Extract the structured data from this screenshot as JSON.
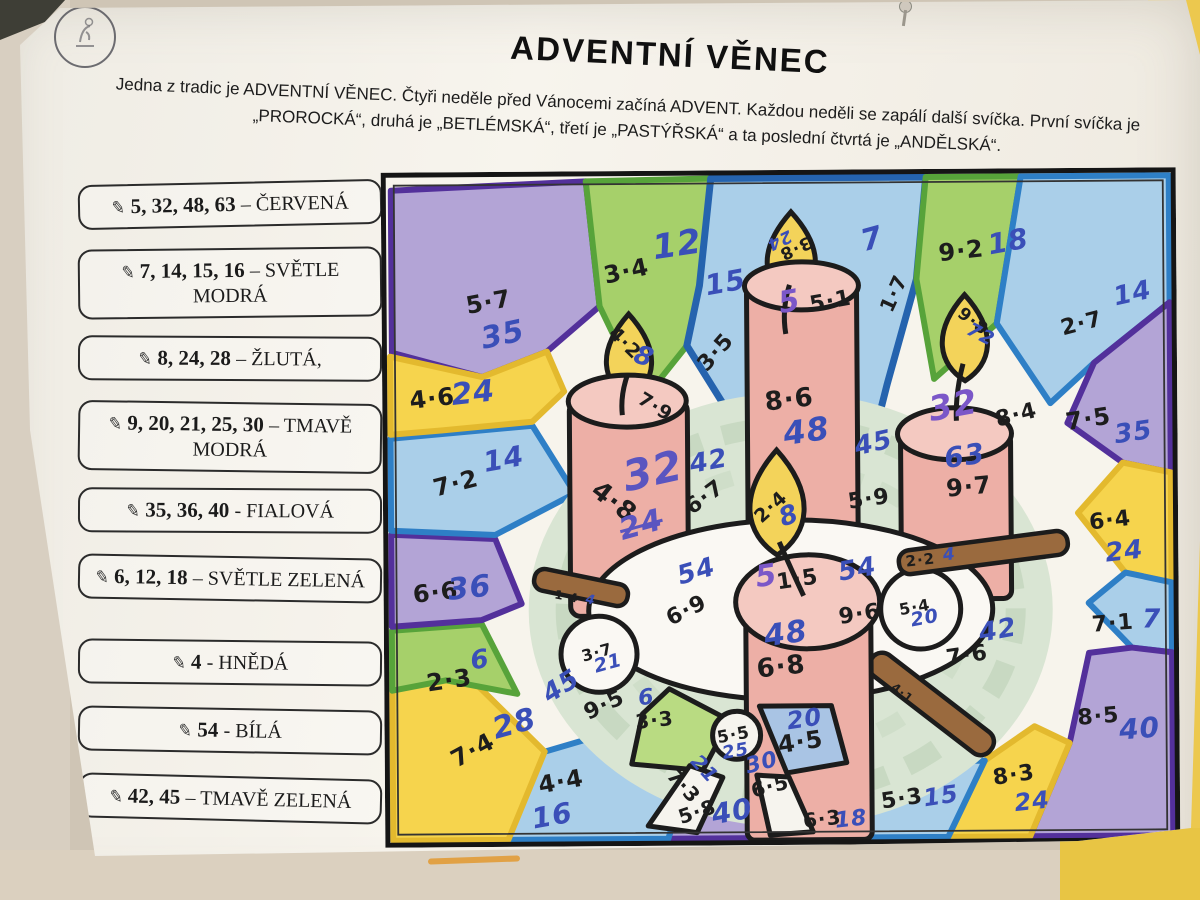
{
  "header": {
    "title": "ADVENTNÍ VĚNEC",
    "intro_line1": "Jedna z tradic je ADVENTNÍ VĚNEC. Čtyři neděle před Vánocemi začíná ADVENT. Každou neděli se zapálí další svíčka. První svíčka je",
    "intro_line2": "„PROROCKÁ“, druhá je „BETLÉMSKÁ“, třetí je „PASTÝŘSKÁ“ a ta poslední čtvrtá je „ANDĚLSKÁ“."
  },
  "decor": {
    "stamp": "school-stamp",
    "pin": "push-pin",
    "pencil_icon": "✎"
  },
  "colors": {
    "pen_blue": "#3a4fb8",
    "pen_purple": "#7b57c8",
    "pen_purple_blue": "#5a55c0",
    "crayon_red": "#edafa6",
    "crayon_yellow": "#f6d44d",
    "crayon_light_blue": "#aacfe9",
    "crayon_dark_blue": "#2e6cb5",
    "crayon_purple": "#b3a4d6",
    "crayon_light_green": "#a6d06a",
    "crayon_dark_green": "#57a33a",
    "crayon_brown": "#9a6a3e"
  },
  "legend": {
    "items": [
      {
        "nums": "5, 32, 48, 63",
        "rest": "– ČERVENÁ"
      },
      {
        "nums": "7, 14, 15, 16",
        "rest": "– SVĚTLE MODRÁ"
      },
      {
        "nums": "8, 24, 28",
        "rest": "– ŽLUTÁ,"
      },
      {
        "nums": "9, 20, 21, 25, 30",
        "rest": "– TMAVĚ MODRÁ"
      },
      {
        "nums": "35, 36, 40",
        "rest": "- FIALOVÁ"
      },
      {
        "nums": "6, 12, 18",
        "rest": "– SVĚTLE ZELENÁ"
      },
      {
        "nums": "4",
        "rest": "- HNĚDÁ"
      },
      {
        "nums": "54",
        "rest": "- BÍLÁ"
      },
      {
        "nums": "42, 45",
        "rest": "– TMAVĚ ZELENÁ"
      }
    ]
  },
  "problems": [
    {
      "p": "5·7",
      "x": 107,
      "y": 130,
      "r": -10,
      "s": 24,
      "a": "35",
      "ac": "blue",
      "ax": 121,
      "ay": 163,
      "ar": -12,
      "as": 30
    },
    {
      "p": "3·4",
      "x": 245,
      "y": 100,
      "r": -12,
      "s": 24,
      "a": "12",
      "ac": "blue",
      "ax": 296,
      "ay": 74,
      "ar": -8,
      "as": 34
    },
    {
      "p": "3·5",
      "x": 334,
      "y": 182,
      "r": -48,
      "s": 22,
      "a": "15",
      "ac": "blue",
      "ax": 344,
      "ay": 112,
      "ar": -10,
      "as": 28
    },
    {
      "p": "1·7",
      "x": 512,
      "y": 124,
      "r": -65,
      "s": 20,
      "a": "7",
      "ac": "blue",
      "ax": 491,
      "ay": 70,
      "ar": -15,
      "as": 30
    },
    {
      "p": "9·2",
      "x": 580,
      "y": 82,
      "r": -6,
      "s": 24,
      "a": "18",
      "ac": "blue",
      "ax": 627,
      "ay": 73,
      "ar": -10,
      "as": 28
    },
    {
      "p": "2·7",
      "x": 700,
      "y": 156,
      "r": -14,
      "s": 22,
      "a": "14",
      "ac": "blue",
      "ax": 751,
      "ay": 126,
      "ar": -12,
      "as": 26
    },
    {
      "p": "7·5",
      "x": 706,
      "y": 251,
      "r": -8,
      "s": 24,
      "a": "35",
      "ac": "blue",
      "ax": 751,
      "ay": 265,
      "ar": -8,
      "as": 26
    },
    {
      "p": "6·4",
      "x": 727,
      "y": 353,
      "r": -6,
      "s": 22,
      "a": "24",
      "ac": "blue",
      "ax": 741,
      "ay": 384,
      "ar": -6,
      "as": 26
    },
    {
      "p": "7·1",
      "x": 729,
      "y": 456,
      "r": -4,
      "s": 22,
      "a": "7",
      "ac": "blue",
      "ax": 768,
      "ay": 452,
      "ar": 0,
      "as": 26
    },
    {
      "p": "8·5",
      "x": 714,
      "y": 549,
      "r": -4,
      "s": 22,
      "a": "40",
      "ac": "blue",
      "ax": 755,
      "ay": 561,
      "ar": -4,
      "as": 28
    },
    {
      "p": "8·3",
      "x": 629,
      "y": 607,
      "r": -8,
      "s": 22,
      "a": "24",
      "ac": "blue",
      "ax": 647,
      "ay": 633,
      "ar": -6,
      "as": 24
    },
    {
      "p": "5·3",
      "x": 517,
      "y": 630,
      "r": -8,
      "s": 22,
      "a": "15",
      "ac": "blue",
      "ax": 556,
      "ay": 627,
      "ar": -8,
      "as": 24
    },
    {
      "p": "6·3",
      "x": 437,
      "y": 649,
      "r": -6,
      "s": 20,
      "a": "18",
      "ac": "blue",
      "ax": 466,
      "ay": 650,
      "ar": -6,
      "as": 22
    },
    {
      "p": "5·8",
      "x": 312,
      "y": 641,
      "r": -18,
      "s": 20,
      "a": "40",
      "ac": "blue",
      "ax": 347,
      "ay": 641,
      "ar": -10,
      "as": 28
    },
    {
      "p": "4·4",
      "x": 176,
      "y": 610,
      "r": -10,
      "s": 24,
      "a": "16",
      "ac": "blue",
      "ax": 167,
      "ay": 644,
      "ar": -10,
      "as": 28
    },
    {
      "p": "7·4",
      "x": 88,
      "y": 578,
      "r": -28,
      "s": 24,
      "a": "28",
      "ac": "blue",
      "ax": 130,
      "ay": 552,
      "ar": -15,
      "as": 30
    },
    {
      "p": "2·3",
      "x": 65,
      "y": 508,
      "r": -8,
      "s": 24,
      "a": "6",
      "ac": "blue",
      "ax": 96,
      "ay": 488,
      "ar": -8,
      "as": 26
    },
    {
      "p": "6·6",
      "x": 52,
      "y": 420,
      "r": -6,
      "s": 24,
      "a": "36",
      "ac": "blue",
      "ax": 86,
      "ay": 416,
      "ar": -6,
      "as": 30
    },
    {
      "p": "7·2",
      "x": 73,
      "y": 311,
      "r": -14,
      "s": 24,
      "a": "14",
      "ac": "blue",
      "ax": 121,
      "ay": 287,
      "ar": -10,
      "as": 28
    },
    {
      "p": "4·6",
      "x": 50,
      "y": 226,
      "r": -6,
      "s": 24,
      "a": "24",
      "ac": "blue",
      "ax": 91,
      "ay": 221,
      "ar": -6,
      "as": 30
    },
    {
      "p": "6·7",
      "x": 322,
      "y": 327,
      "r": -36,
      "s": 22,
      "a": "42",
      "ac": "blue",
      "ax": 326,
      "ay": 291,
      "ar": -10,
      "as": 26
    },
    {
      "p": "5·9",
      "x": 486,
      "y": 330,
      "r": -8,
      "s": 22,
      "a": "45",
      "ac": "blue",
      "ax": 491,
      "ay": 274,
      "ar": -12,
      "as": 26
    },
    {
      "p": "6·9",
      "x": 303,
      "y": 440,
      "r": -26,
      "s": 22,
      "a": "54",
      "ac": "blue",
      "ax": 313,
      "ay": 401,
      "ar": -16,
      "as": 26
    },
    {
      "p": "9·6",
      "x": 476,
      "y": 445,
      "r": -8,
      "s": 22,
      "a": "54",
      "ac": "blue",
      "ax": 474,
      "ay": 400,
      "ar": -10,
      "as": 26
    },
    {
      "p": "9·5",
      "x": 220,
      "y": 534,
      "r": -25,
      "s": 22,
      "a": "45",
      "ac": "blue",
      "ax": 177,
      "ay": 515,
      "ar": -32,
      "as": 26
    },
    {
      "p": "7·6",
      "x": 583,
      "y": 487,
      "r": -8,
      "s": 22,
      "a": "42",
      "ac": "blue",
      "ax": 614,
      "ay": 462,
      "ar": -10,
      "as": 26
    },
    {
      "p": "3·7",
      "x": 213,
      "y": 481,
      "r": -15,
      "s": 16,
      "a": "21",
      "ac": "blue",
      "ax": 224,
      "ay": 492,
      "ar": -15,
      "as": 19
    },
    {
      "p": "5·4",
      "x": 531,
      "y": 438,
      "r": -10,
      "s": 16,
      "a": "20",
      "ac": "blue",
      "ax": 541,
      "ay": 449,
      "ar": -10,
      "as": 19
    },
    {
      "p": "1·4",
      "x": 183,
      "y": 425,
      "r": 11,
      "s": 12,
      "a": "4",
      "ac": "blue",
      "ax": 207,
      "ay": 429,
      "ar": 11,
      "as": 13
    },
    {
      "p": "2·2",
      "x": 537,
      "y": 391,
      "r": -6,
      "s": 15,
      "a": "4",
      "ac": "blue",
      "ax": 566,
      "ay": 386,
      "ar": -6,
      "as": 17
    },
    {
      "p": "4·1",
      "x": 518,
      "y": 524,
      "r": 38,
      "s": 12,
      "a": "",
      "ac": "blue",
      "ax": 0,
      "ay": 0,
      "ar": 0,
      "as": 0
    },
    {
      "p": "4·2",
      "x": 243,
      "y": 172,
      "r": 45,
      "s": 19,
      "a": "8",
      "ac": "blue",
      "ax": 262,
      "ay": 186,
      "ar": 20,
      "as": 26
    },
    {
      "p": "7·9",
      "x": 273,
      "y": 236,
      "r": 32,
      "s": 19,
      "a": "",
      "ac": "blue",
      "ax": 0,
      "ay": 0,
      "ar": 0,
      "as": 0
    },
    {
      "p": "4·8",
      "x": 231,
      "y": 331,
      "r": 38,
      "s": 26,
      "a": "32",
      "ac": "purpleblue",
      "ax": 270,
      "ay": 300,
      "ar": -12,
      "as": 42,
      "strike": {
        "t": "24",
        "x": 258,
        "y": 354,
        "r": -15,
        "s": 30
      }
    },
    {
      "p": "3·8",
      "x": 414,
      "y": 78,
      "r": 155,
      "s": 17,
      "a": "24",
      "ac": "blue",
      "ax": 398,
      "ay": 70,
      "ar": 155,
      "as": 17
    },
    {
      "p": "5·1",
      "x": 449,
      "y": 132,
      "r": -10,
      "s": 22,
      "a": "5",
      "ac": "purple",
      "ax": 408,
      "ay": 132,
      "ar": -10,
      "as": 30
    },
    {
      "p": "8·6",
      "x": 407,
      "y": 230,
      "r": -6,
      "s": 26,
      "a": "48",
      "ac": "blue",
      "ax": 424,
      "ay": 261,
      "ar": -8,
      "as": 32
    },
    {
      "p": "2·4",
      "x": 388,
      "y": 337,
      "r": -42,
      "s": 19,
      "a": "8",
      "ac": "blue",
      "ax": 406,
      "ay": 346,
      "ar": -20,
      "as": 26
    },
    {
      "p": "1·5",
      "x": 414,
      "y": 410,
      "r": -8,
      "s": 22,
      "a": "5",
      "ac": "purple",
      "ax": 383,
      "ay": 406,
      "ar": -8,
      "as": 30
    },
    {
      "p": "6·8",
      "x": 397,
      "y": 497,
      "r": -6,
      "s": 26,
      "a": "48",
      "ac": "blue",
      "ax": 402,
      "ay": 464,
      "ar": -8,
      "as": 30
    },
    {
      "p": "9·8",
      "x": 591,
      "y": 153,
      "r": 38,
      "s": 17,
      "a": "72",
      "ac": "blue",
      "ax": 599,
      "ay": 166,
      "ar": 28,
      "as": 19
    },
    {
      "p": "8·4",
      "x": 634,
      "y": 247,
      "r": -14,
      "s": 22,
      "a": "32",
      "ac": "purple",
      "ax": 571,
      "ay": 237,
      "ar": -10,
      "as": 34
    },
    {
      "p": "9·7",
      "x": 586,
      "y": 318,
      "r": -5,
      "s": 24,
      "a": "63",
      "ac": "blue",
      "ax": 582,
      "ay": 287,
      "ar": -8,
      "as": 28
    },
    {
      "p": "3·3",
      "x": 270,
      "y": 549,
      "r": -6,
      "s": 20,
      "a": "6",
      "ac": "blue",
      "ax": 262,
      "ay": 527,
      "ar": -6,
      "as": 22
    },
    {
      "p": "5·5",
      "x": 349,
      "y": 565,
      "r": -10,
      "s": 17,
      "a": "25",
      "ac": "blue",
      "ax": 351,
      "ay": 581,
      "ar": -10,
      "as": 18
    },
    {
      "p": "4·5",
      "x": 416,
      "y": 572,
      "r": -8,
      "s": 24,
      "a": "20",
      "ac": "blue",
      "ax": 420,
      "ay": 549,
      "ar": -8,
      "as": 24
    },
    {
      "p": "7·3",
      "x": 299,
      "y": 615,
      "r": 48,
      "s": 20,
      "a": "21",
      "ac": "blue",
      "ax": 320,
      "ay": 598,
      "ar": 48,
      "as": 20
    },
    {
      "p": "6·5",
      "x": 385,
      "y": 616,
      "r": -14,
      "s": 20,
      "a": "30",
      "ac": "blue",
      "ax": 377,
      "ay": 593,
      "ar": -14,
      "as": 22
    }
  ]
}
